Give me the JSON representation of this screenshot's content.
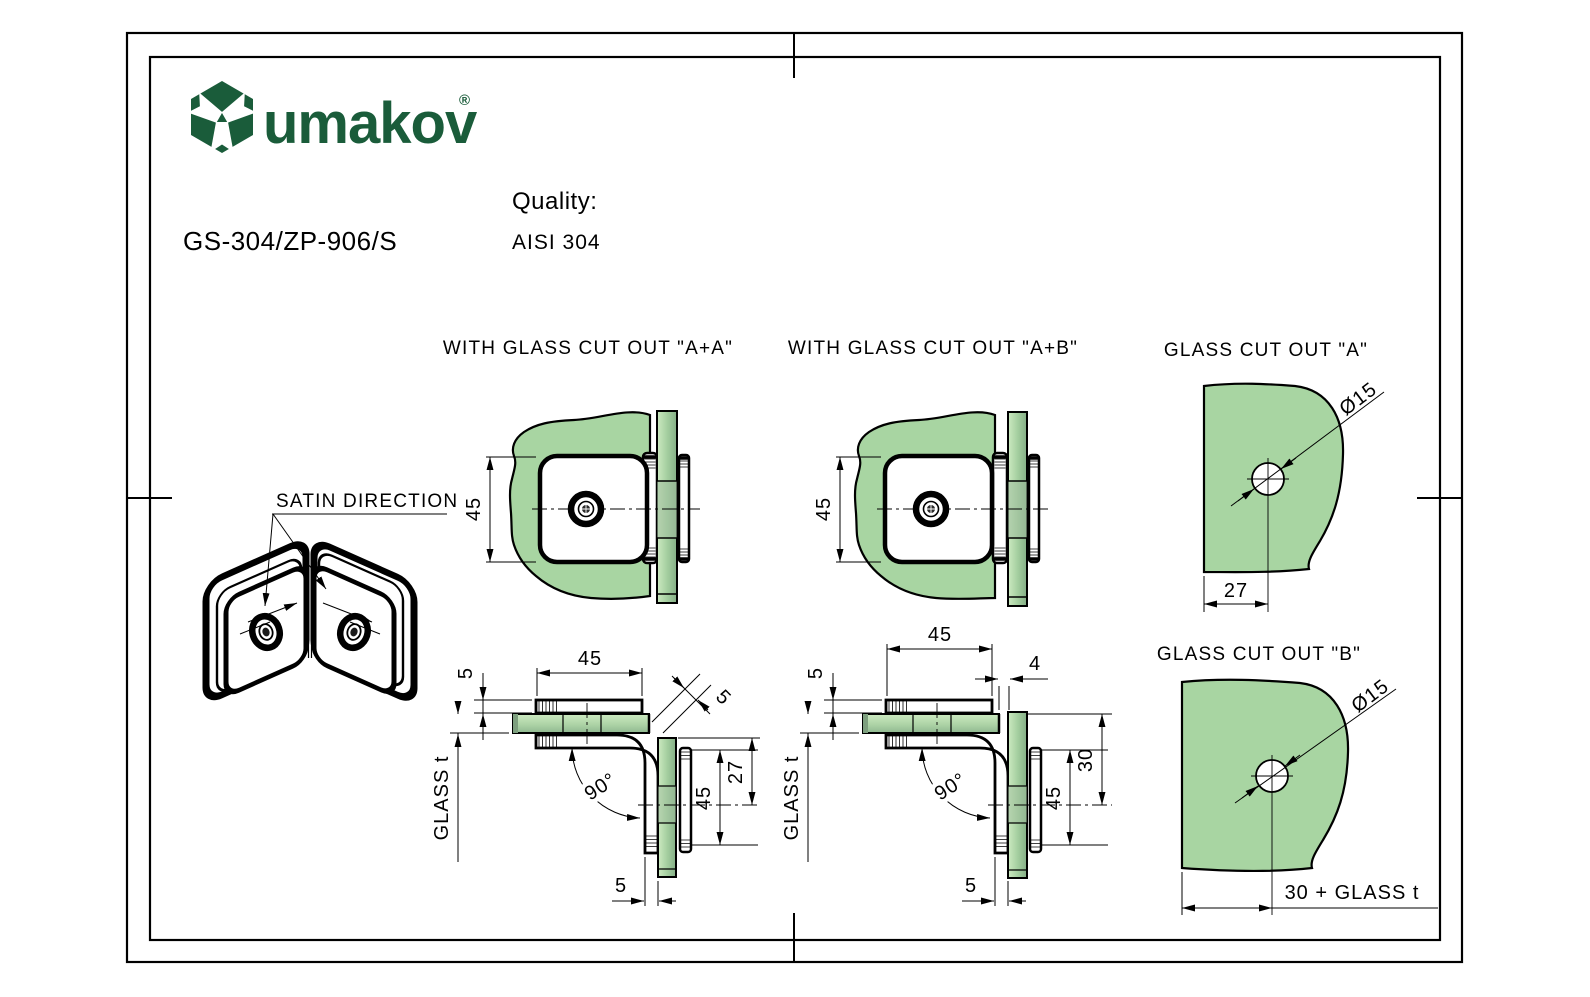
{
  "colors": {
    "brand_green": "#1a5c3a",
    "glass_green": "#a8d5a2",
    "glass_highlight": "#c9e7bd",
    "glass_shadow": "#83ad85",
    "line": "#000000"
  },
  "header": {
    "brand": "umakov",
    "registered": "®",
    "product_code": "GS-304/ZP-906/S",
    "quality_label": "Quality:",
    "quality_value": "AISI 304"
  },
  "iso_view": {
    "label": "SATIN DIRECTION"
  },
  "view_top_aa": {
    "title": "WITH GLASS CUT OUT \"A+A\"",
    "dim_45": "45"
  },
  "view_top_ab": {
    "title": "WITH GLASS CUT OUT \"A+B\"",
    "dim_45": "45"
  },
  "view_cutout_a": {
    "title": "GLASS CUT OUT \"A\"",
    "dim_diameter": "Ø15",
    "dim_width": "27"
  },
  "view_cutout_b": {
    "title": "GLASS CUT OUT \"B\"",
    "dim_diameter": "Ø15",
    "dim_width": "30 + GLASS t"
  },
  "view_side_aa": {
    "dim_top_45": "45",
    "dim_plate_5": "5",
    "dim_glass_t": "GLASS t",
    "dim_angle": "90°",
    "dim_corner_5": "5",
    "dim_right_45": "45",
    "dim_right_27": "27",
    "dim_bottom_5": "5"
  },
  "view_side_ab": {
    "dim_top_45": "45",
    "dim_gap_4": "4",
    "dim_plate_5": "5",
    "dim_glass_t": "GLASS t",
    "dim_angle": "90°",
    "dim_right_45": "45",
    "dim_right_30": "30",
    "dim_bottom_5": "5"
  }
}
